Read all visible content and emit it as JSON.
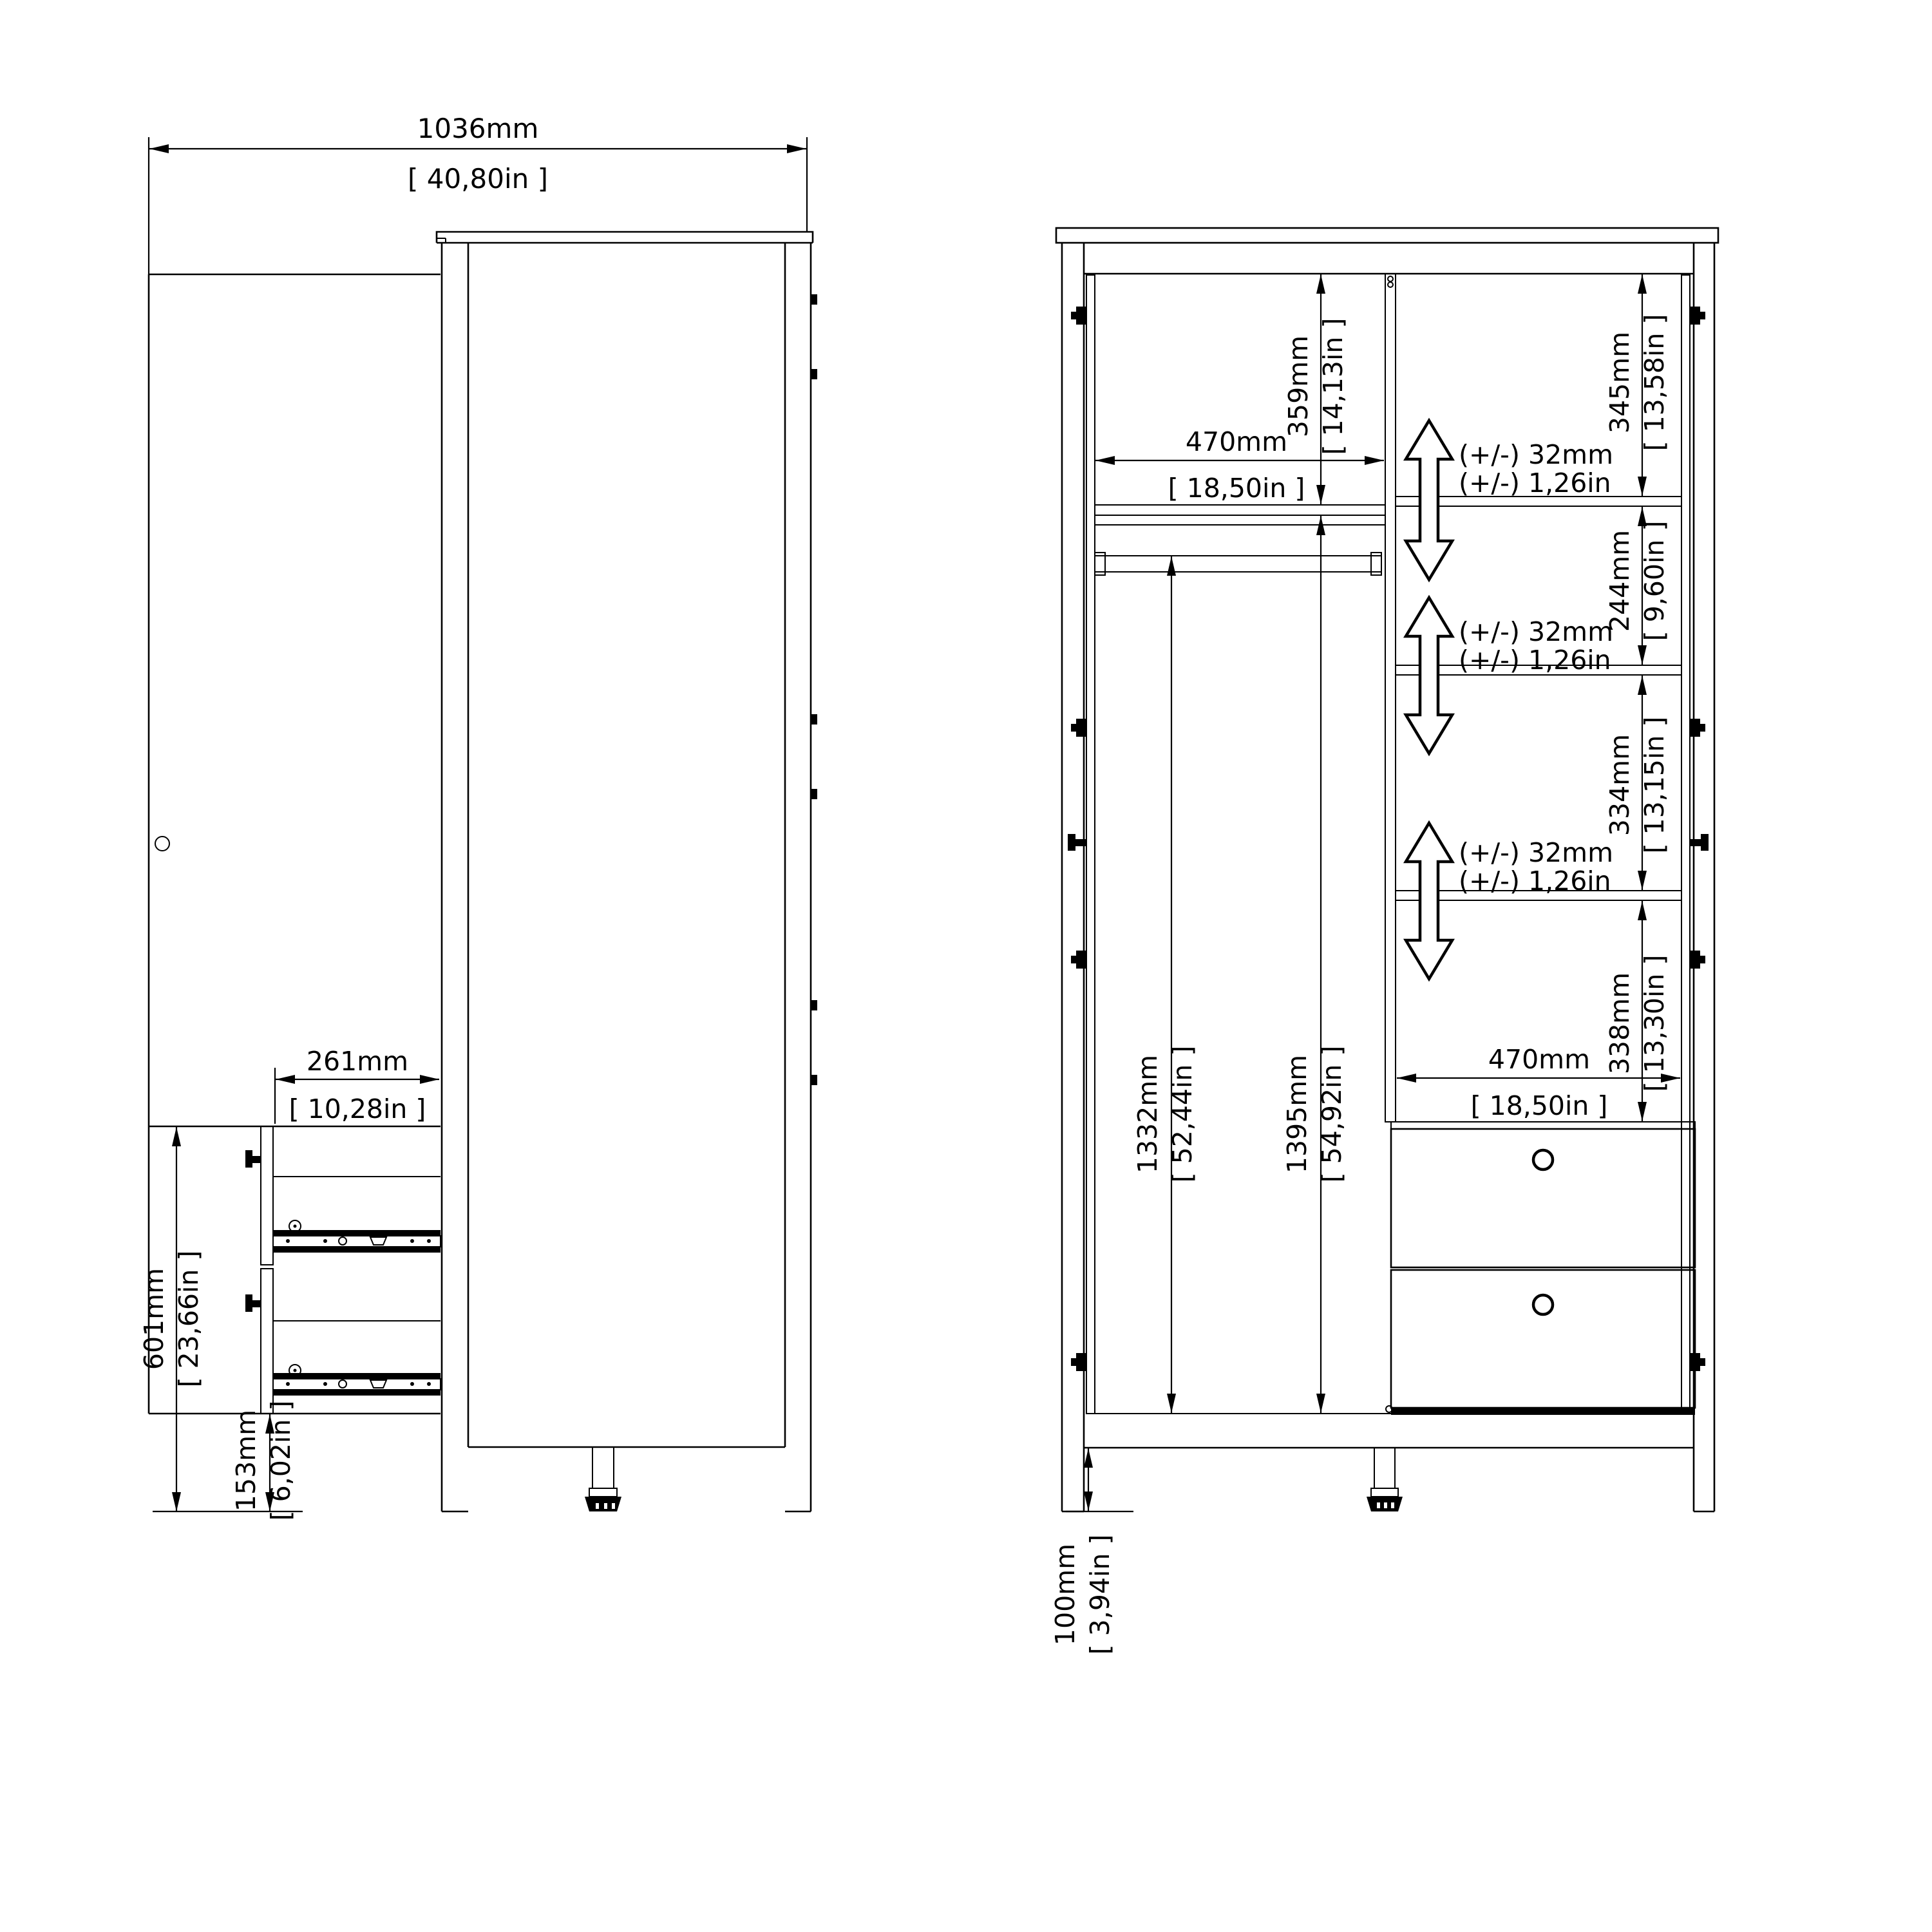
{
  "side_view": {
    "width": {
      "mm": "1036mm",
      "inch": "[ 40,80in ]"
    },
    "drawer_depth": {
      "mm": "261mm",
      "inch": "[ 10,28in ]"
    },
    "drawer_unit_height": {
      "mm": "601mm",
      "inch": "[ 23,66in ]"
    },
    "base_height": {
      "mm": "153mm",
      "inch": "[ 6,02in ]"
    }
  },
  "front_view": {
    "top_section": {
      "mm": "359mm",
      "inch": "[ 14,13in ]"
    },
    "shelf_width_top": {
      "mm": "470mm",
      "inch": "[ 18,50in ]"
    },
    "space_1": {
      "mm": "345mm",
      "inch": "[ 13,58in ]"
    },
    "space_2": {
      "mm": "244mm",
      "inch": "[ 9,60in ]"
    },
    "space_3": {
      "mm": "334mm",
      "inch": "[ 13,15in ]"
    },
    "space_4": {
      "mm": "338mm",
      "inch": "[ 13,30in ]"
    },
    "interior_height": {
      "mm": "1332mm",
      "inch": "[ 52,44in ]"
    },
    "door_height": {
      "mm": "1395mm",
      "inch": "[ 54,92in ]"
    },
    "shelf_width_bottom": {
      "mm": "470mm",
      "inch": "[ 18,50in ]"
    },
    "leg_height": {
      "mm": "100mm",
      "inch": "[ 3,94in ]"
    },
    "shelf_adjust": {
      "mm": "(+/-) 32mm",
      "inch": "(+/-) 1,26in"
    }
  },
  "colors": {
    "line": "#000000",
    "background": "#ffffff"
  }
}
